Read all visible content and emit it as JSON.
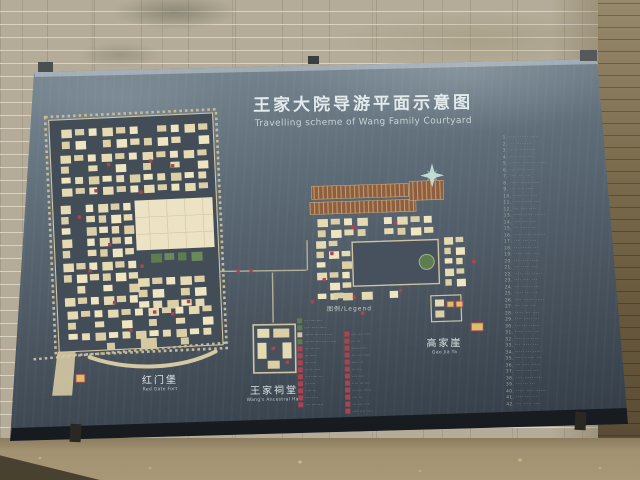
{
  "board": {
    "title": "王家大院导游平面示意图",
    "subtitle": "Travelling scheme of Wang Family Courtyard"
  },
  "labels": {
    "red_gate_fort_cn": "红门堡",
    "red_gate_fort_en": "Red Gate Fort",
    "ancestral_hall_cn": "王家祠堂",
    "ancestral_hall_en": "Wang's Ancestral Hall",
    "gao_jia_ya_cn": "高家崖",
    "gao_jia_ya_en": "Gao Jia Ya"
  },
  "legend": {
    "header": "图例/Legend",
    "left_items": [
      {
        "color": "green",
        "text": "··· ····· ····"
      },
      {
        "color": "green",
        "text": "····· ···· ······"
      },
      {
        "color": "beige",
        "text": "······· ····· ··· ····"
      },
      {
        "color": "green",
        "text": "········ ···· ··· ·· ····"
      },
      {
        "color": "red",
        "text": "···· ··· ···"
      },
      {
        "color": "red",
        "text": "··· ·····"
      },
      {
        "color": "red",
        "text": "···· ····"
      },
      {
        "color": "red",
        "text": "··· ··· ····"
      },
      {
        "color": "red",
        "text": "···· ····· ···"
      },
      {
        "color": "red",
        "text": "··· ····"
      },
      {
        "color": "red",
        "text": "····· ···"
      },
      {
        "color": "red",
        "text": "··· ·· ···"
      },
      {
        "color": "red",
        "text": "···· ···· ····"
      }
    ],
    "right_items": [
      {
        "color": "red",
        "text": "···· ···· ·····"
      },
      {
        "color": "red",
        "text": "··· ···"
      },
      {
        "color": "red",
        "text": "····· ······"
      },
      {
        "color": "red",
        "text": "···· ··· ·····"
      },
      {
        "color": "red",
        "text": "····· ···"
      },
      {
        "color": "red",
        "text": "··· ····"
      },
      {
        "color": "red",
        "text": "···· ·····"
      },
      {
        "color": "red",
        "text": "····· ··· ····"
      },
      {
        "color": "red",
        "text": "··· ···· ······"
      },
      {
        "color": "red",
        "text": "···· ···"
      },
      {
        "color": "red",
        "text": "··· ····· ····"
      },
      {
        "color": "red",
        "text": "····· ···· ·····"
      }
    ]
  },
  "index_list": {
    "lines": [
      "1. ···· ······ ····",
      "2. ··· ····· ···",
      "3. ····· ··· ·····",
      "4. ···· ···· ···",
      "5. ······ ········ ·····",
      "6. ··· ····· ····",
      "7. ···· ··· ···",
      "8. ····· ······ ····",
      "9. ··· ···· ·····",
      "10. ····· ··· ····",
      "11. ···· ······ ···",
      "12. ··· ···· ····",
      "13. ····· ····· ······",
      "14. ···· ··· ····",
      "15. ··· ····· ···",
      "16. ····· ···· ·······",
      "17. ···· ··· ····",
      "18. ··· ······ ···",
      "19. ····· ···· ····",
      "20. ···· ··· ·····",
      "21. ··· ····· ···",
      "22. ····· ··· ······",
      "23. ···· ···· ···",
      "24. ··· ····· ····",
      "25. ····· ··· ···",
      "26. ···· ······ ·····",
      "27. ··· ···· ···",
      "28. ····· ··· ····",
      "29. ···· ····· ···",
      "30. ··· ··· ······",
      "31. ····· ···· ···",
      "32. ···· ··· ·····",
      "33. ··· ····· ···",
      "34. ····· ··· ····",
      "35. ···· ······ ···",
      "36. ··· ···· ·····",
      "37. ····· ··· ···",
      "38. ···· ····· ····",
      "39. ··· ··· ···",
      "40. ····· ···· ······",
      "41. ···· ··· ···",
      "42. ··· ····· ····"
    ]
  },
  "icons": {
    "compass": "eight-point-star"
  },
  "colors": {
    "board_top": "#8c99a3",
    "board_bottom": "#2d343d",
    "building_beige": "#e6dab2",
    "building_green": "#5e7c50",
    "building_brown": "#8d5e40",
    "marker_red": "#b2434e",
    "wall_brick": "#b4ac98",
    "ground": "#a29172",
    "title_text": "#e3eaec"
  }
}
